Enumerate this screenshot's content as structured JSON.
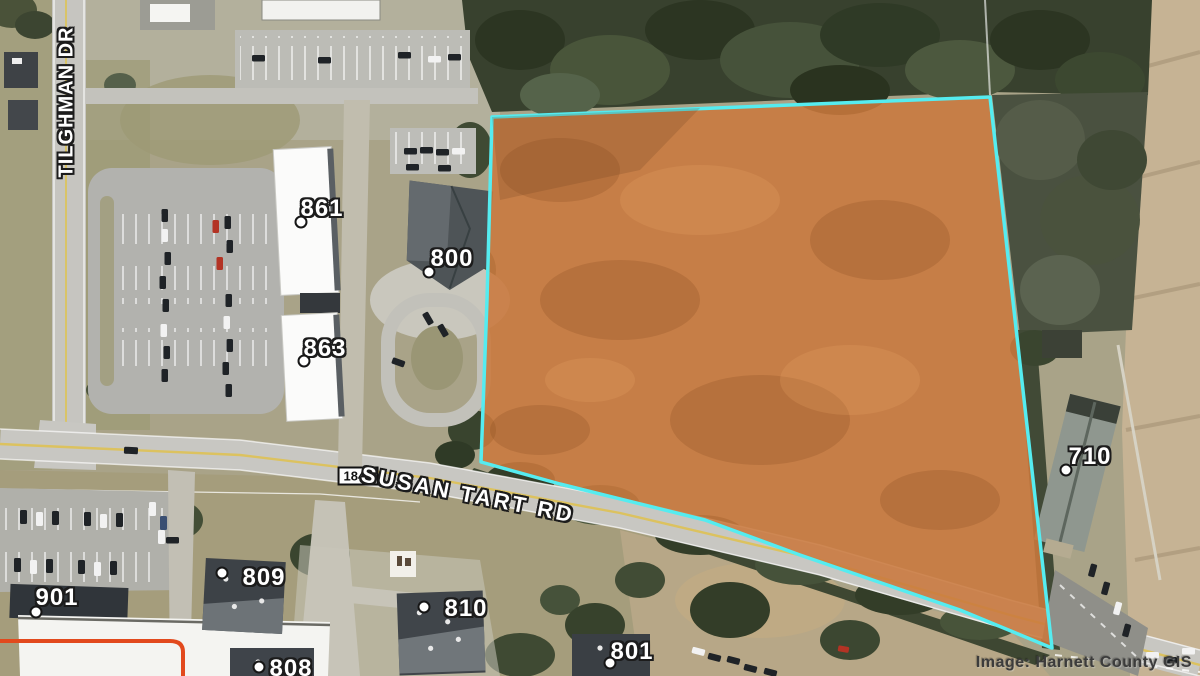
{
  "attribution": "Image: Harnett County GIS",
  "roads": {
    "tilghman": {
      "label": "TILGHMAN DR"
    },
    "susan_tart": {
      "label": "SUSAN TART RD",
      "route_number": "1844"
    }
  },
  "parcel": {
    "fill_color": "#c9793d",
    "outline_color": "#55ecf0"
  },
  "secondary_boundary_color": "#e2491d",
  "address_labels": [
    {
      "text": "861",
      "x": 322,
      "y": 209,
      "mx": 301,
      "my": 222
    },
    {
      "text": "800",
      "x": 452,
      "y": 259,
      "mx": 429,
      "my": 272
    },
    {
      "text": "863",
      "x": 325,
      "y": 349,
      "mx": 304,
      "my": 361
    },
    {
      "text": "901",
      "x": 57,
      "y": 598,
      "mx": 36,
      "my": 612
    },
    {
      "text": "809",
      "x": 264,
      "y": 578,
      "mx": 222,
      "my": 573
    },
    {
      "text": "810",
      "x": 466,
      "y": 609,
      "mx": 424,
      "my": 607
    },
    {
      "text": "808",
      "x": 291,
      "y": 669,
      "mx": 259,
      "my": 667
    },
    {
      "text": "801",
      "x": 632,
      "y": 652,
      "mx": 610,
      "my": 663
    },
    {
      "text": "710",
      "x": 1090,
      "y": 457,
      "mx": 1066,
      "my": 470
    }
  ]
}
